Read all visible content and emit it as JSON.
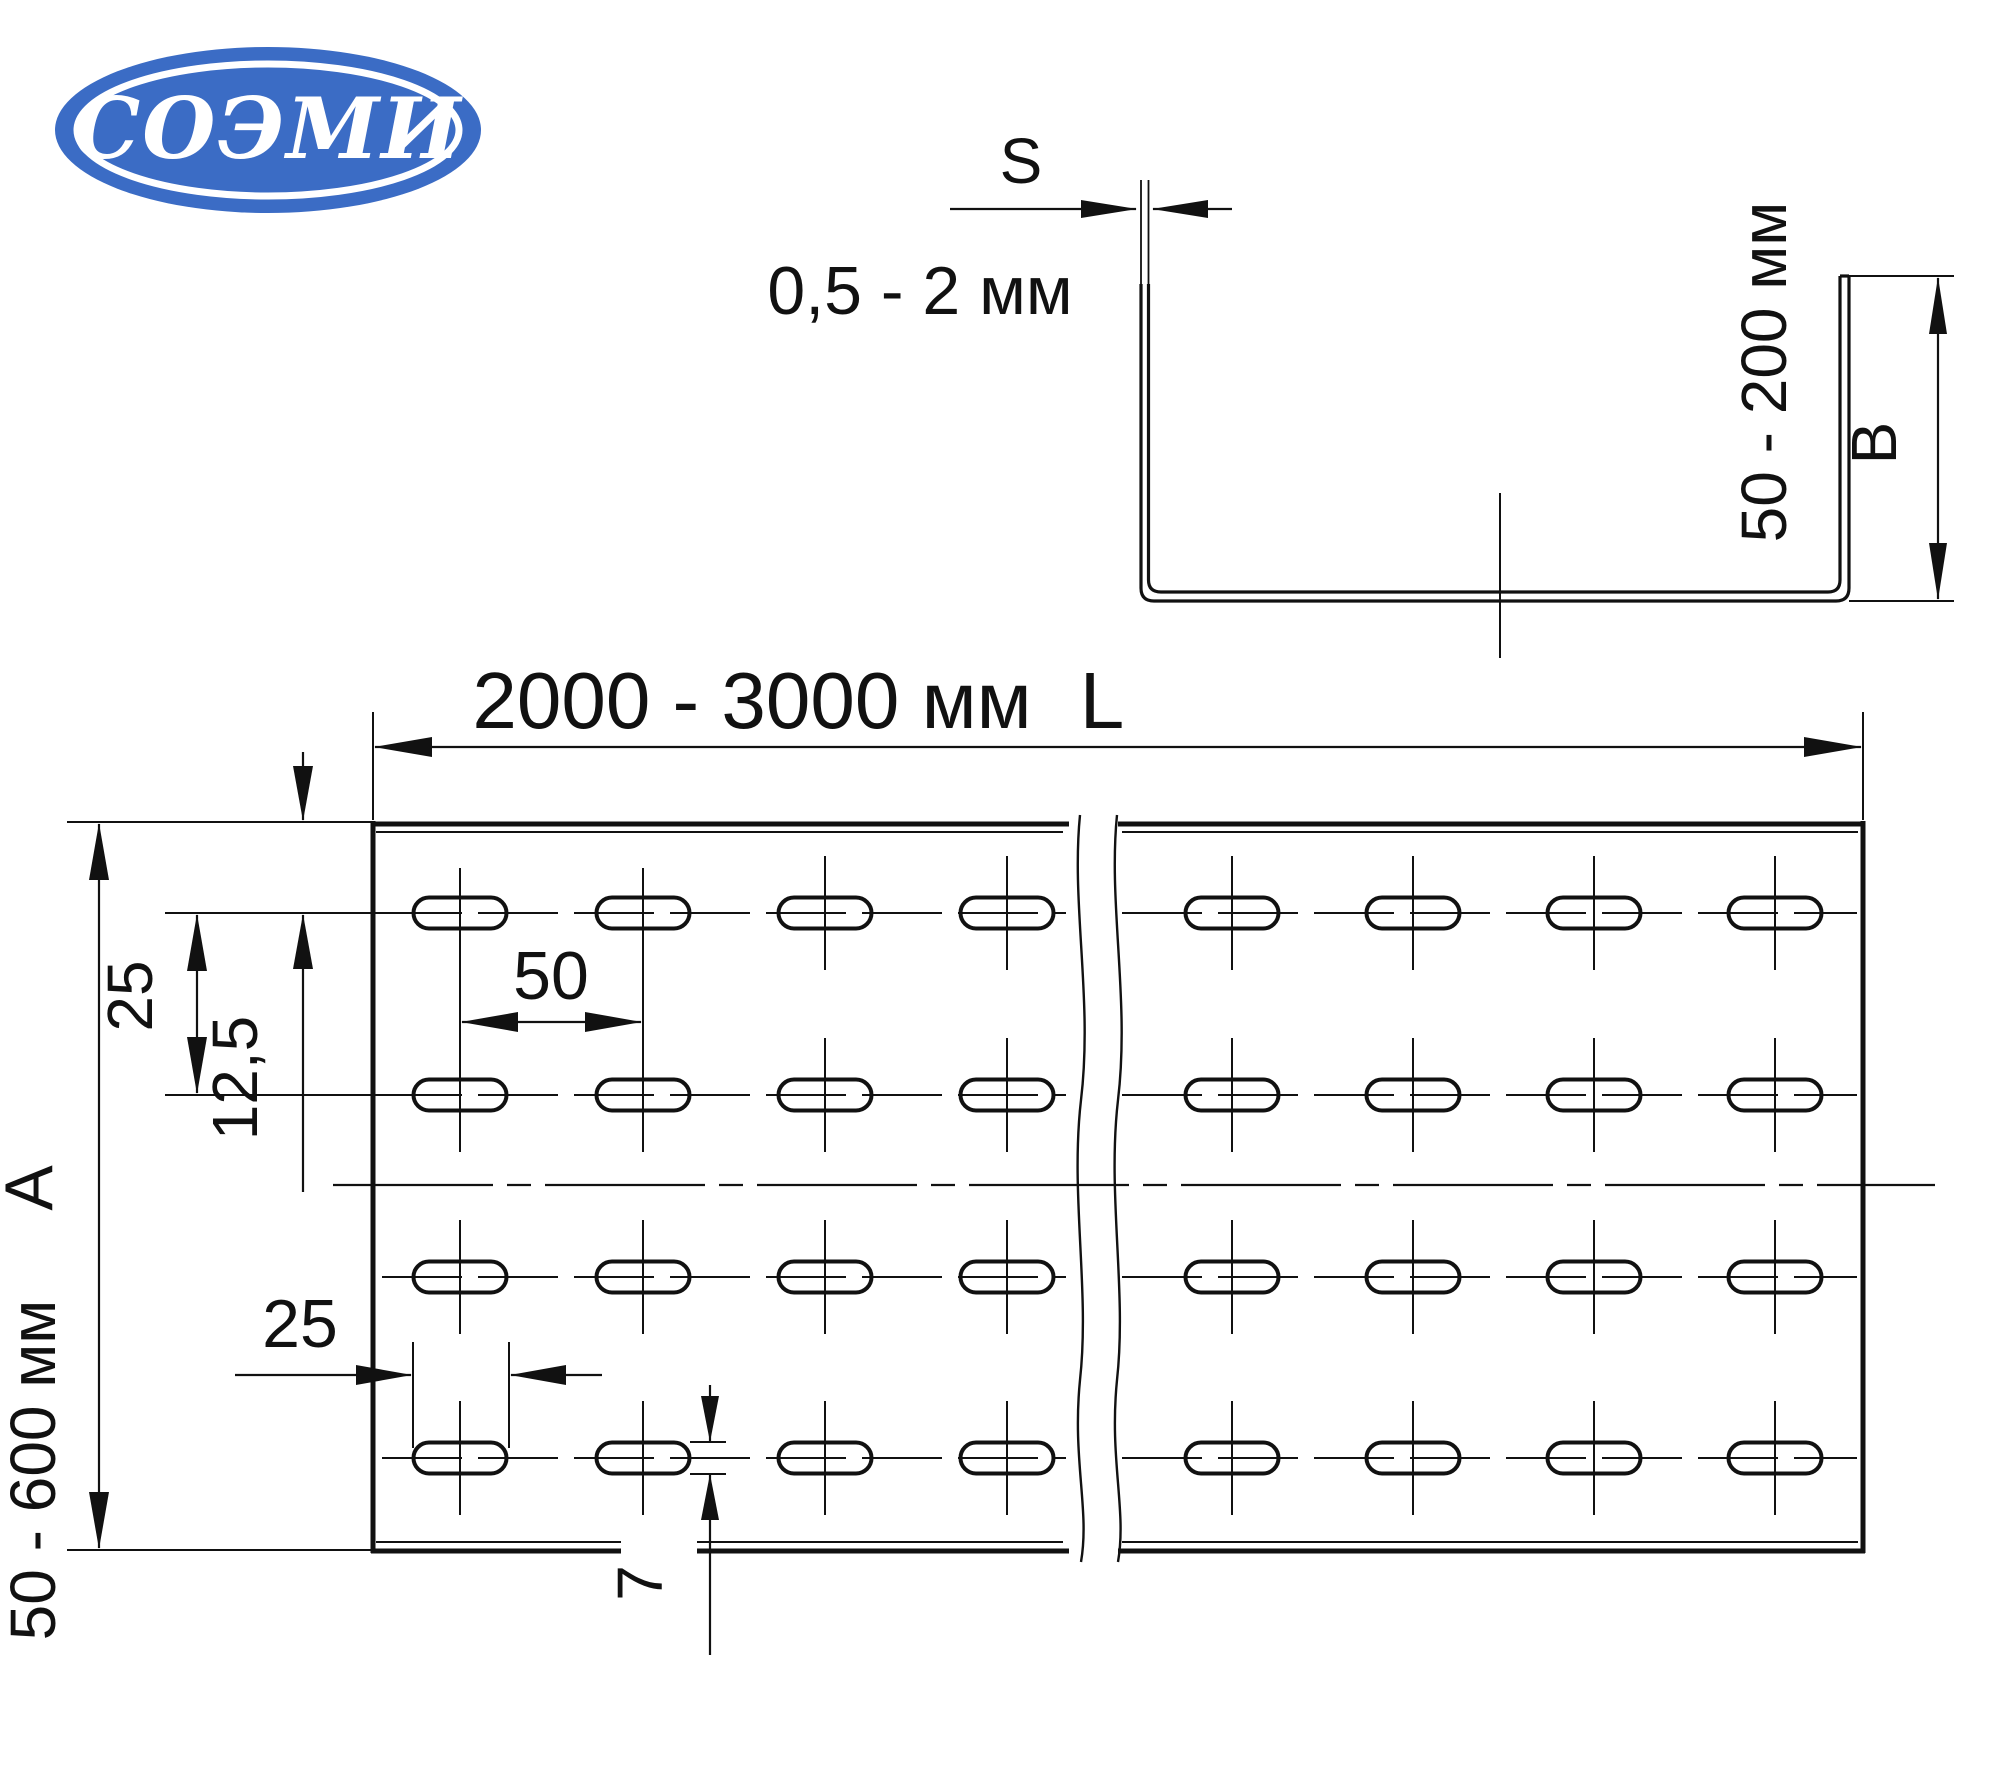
{
  "colors": {
    "line": "#111111",
    "background": "#ffffff",
    "logo_blue": "#3b6cc5",
    "logo_text_color": "#ffffff"
  },
  "logo": {
    "text": "СОЭМИ"
  },
  "cross_section_view": {
    "thickness_symbol": "S",
    "thickness_range": "0,5 - 2 мм",
    "height_range": "50 - 200 мм",
    "height_symbol": "B"
  },
  "plan_view": {
    "length_range": "2000 - 3000 мм",
    "length_symbol": "L",
    "width_range": "50 - 600 мм",
    "width_symbol": "A",
    "row_pitch": "25",
    "edge_offset": "12,5",
    "slot_pitch": "50",
    "slot_length": "25",
    "slot_width": "7"
  }
}
